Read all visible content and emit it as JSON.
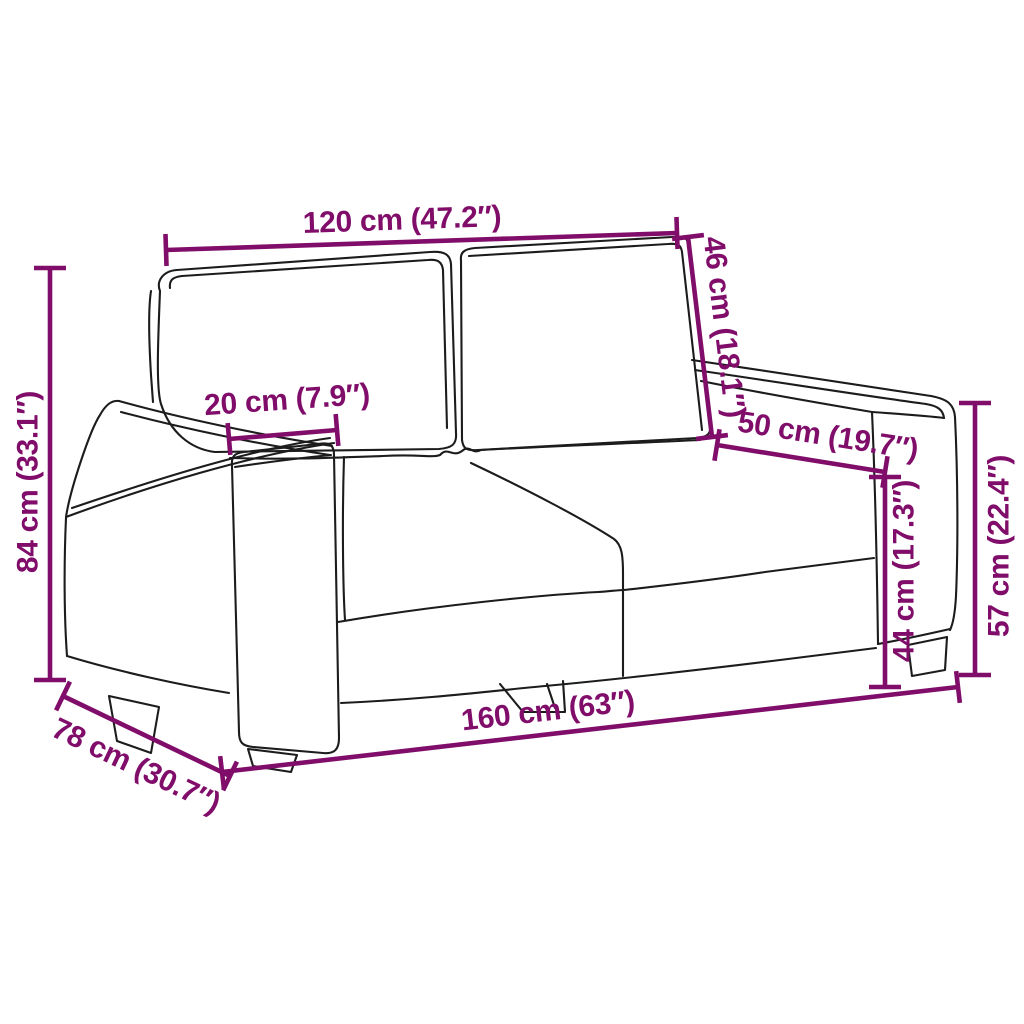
{
  "diagram": {
    "kind": "product-dimension-diagram",
    "subject": "two-seater sofa line drawing",
    "units": "cm and inches"
  },
  "colors": {
    "dimension": "#800d6a",
    "outline": "#1c1c1c",
    "background": "#ffffff"
  },
  "dimension_style": {
    "line_width": 4.6,
    "tick_half_length": 16,
    "font_size": 30
  },
  "dimensions": [
    {
      "id": "back-width",
      "label": "120 cm (47.2″)",
      "value_cm": 120,
      "value_in": 47.2,
      "line": {
        "x1": 166,
        "y1": 250,
        "x2": 677,
        "y2": 233
      },
      "text": {
        "x": 402,
        "y": 220,
        "rotation": -2
      }
    },
    {
      "id": "backrest-height",
      "label": "46 cm (18.1″)",
      "value_cm": 46,
      "value_in": 18.1,
      "line": {
        "x1": 688,
        "y1": 237,
        "x2": 712,
        "y2": 437
      },
      "text": {
        "x": 724,
        "y": 327,
        "rotation": 83
      }
    },
    {
      "id": "seat-depth",
      "label": "50 cm (19.7″)",
      "value_cm": 50,
      "value_in": 19.7,
      "line": {
        "x1": 717,
        "y1": 445,
        "x2": 885,
        "y2": 472
      },
      "text": {
        "x": 828,
        "y": 436,
        "rotation": 9
      }
    },
    {
      "id": "armrest-width",
      "label": "20 cm (7.9″)",
      "value_cm": 20,
      "value_in": 7.9,
      "line": {
        "x1": 229,
        "y1": 439,
        "x2": 337,
        "y2": 430
      },
      "text": {
        "x": 287,
        "y": 400,
        "rotation": -4
      }
    },
    {
      "id": "overall-height",
      "label": "84 cm (33.1″)",
      "value_cm": 84,
      "value_in": 33.1,
      "line": {
        "x1": 50,
        "y1": 268,
        "x2": 50,
        "y2": 680
      },
      "text": {
        "x": 28,
        "y": 482,
        "rotation": -90
      }
    },
    {
      "id": "seat-height",
      "label": "44 cm (17.3″)",
      "value_cm": 44,
      "value_in": 17.3,
      "line": {
        "x1": 885,
        "y1": 477,
        "x2": 885,
        "y2": 687
      },
      "text": {
        "x": 904,
        "y": 571,
        "rotation": -90
      }
    },
    {
      "id": "armrest-height",
      "label": "57 cm (22.4″)",
      "value_cm": 57,
      "value_in": 22.4,
      "line": {
        "x1": 975,
        "y1": 403,
        "x2": 975,
        "y2": 675
      },
      "text": {
        "x": 999,
        "y": 546,
        "rotation": -90
      }
    },
    {
      "id": "overall-width",
      "label": "160 cm (63″)",
      "value_cm": 160,
      "value_in": 63,
      "line": {
        "x1": 222,
        "y1": 772,
        "x2": 958,
        "y2": 687
      },
      "text": {
        "x": 548,
        "y": 711,
        "rotation": -6.6
      }
    },
    {
      "id": "overall-depth",
      "label": "78 cm (30.7″)",
      "value_cm": 78,
      "value_in": 30.7,
      "line": {
        "x1": 63,
        "y1": 696,
        "x2": 230,
        "y2": 776
      },
      "text": {
        "x": 136,
        "y": 766,
        "rotation": 25.6
      }
    }
  ]
}
